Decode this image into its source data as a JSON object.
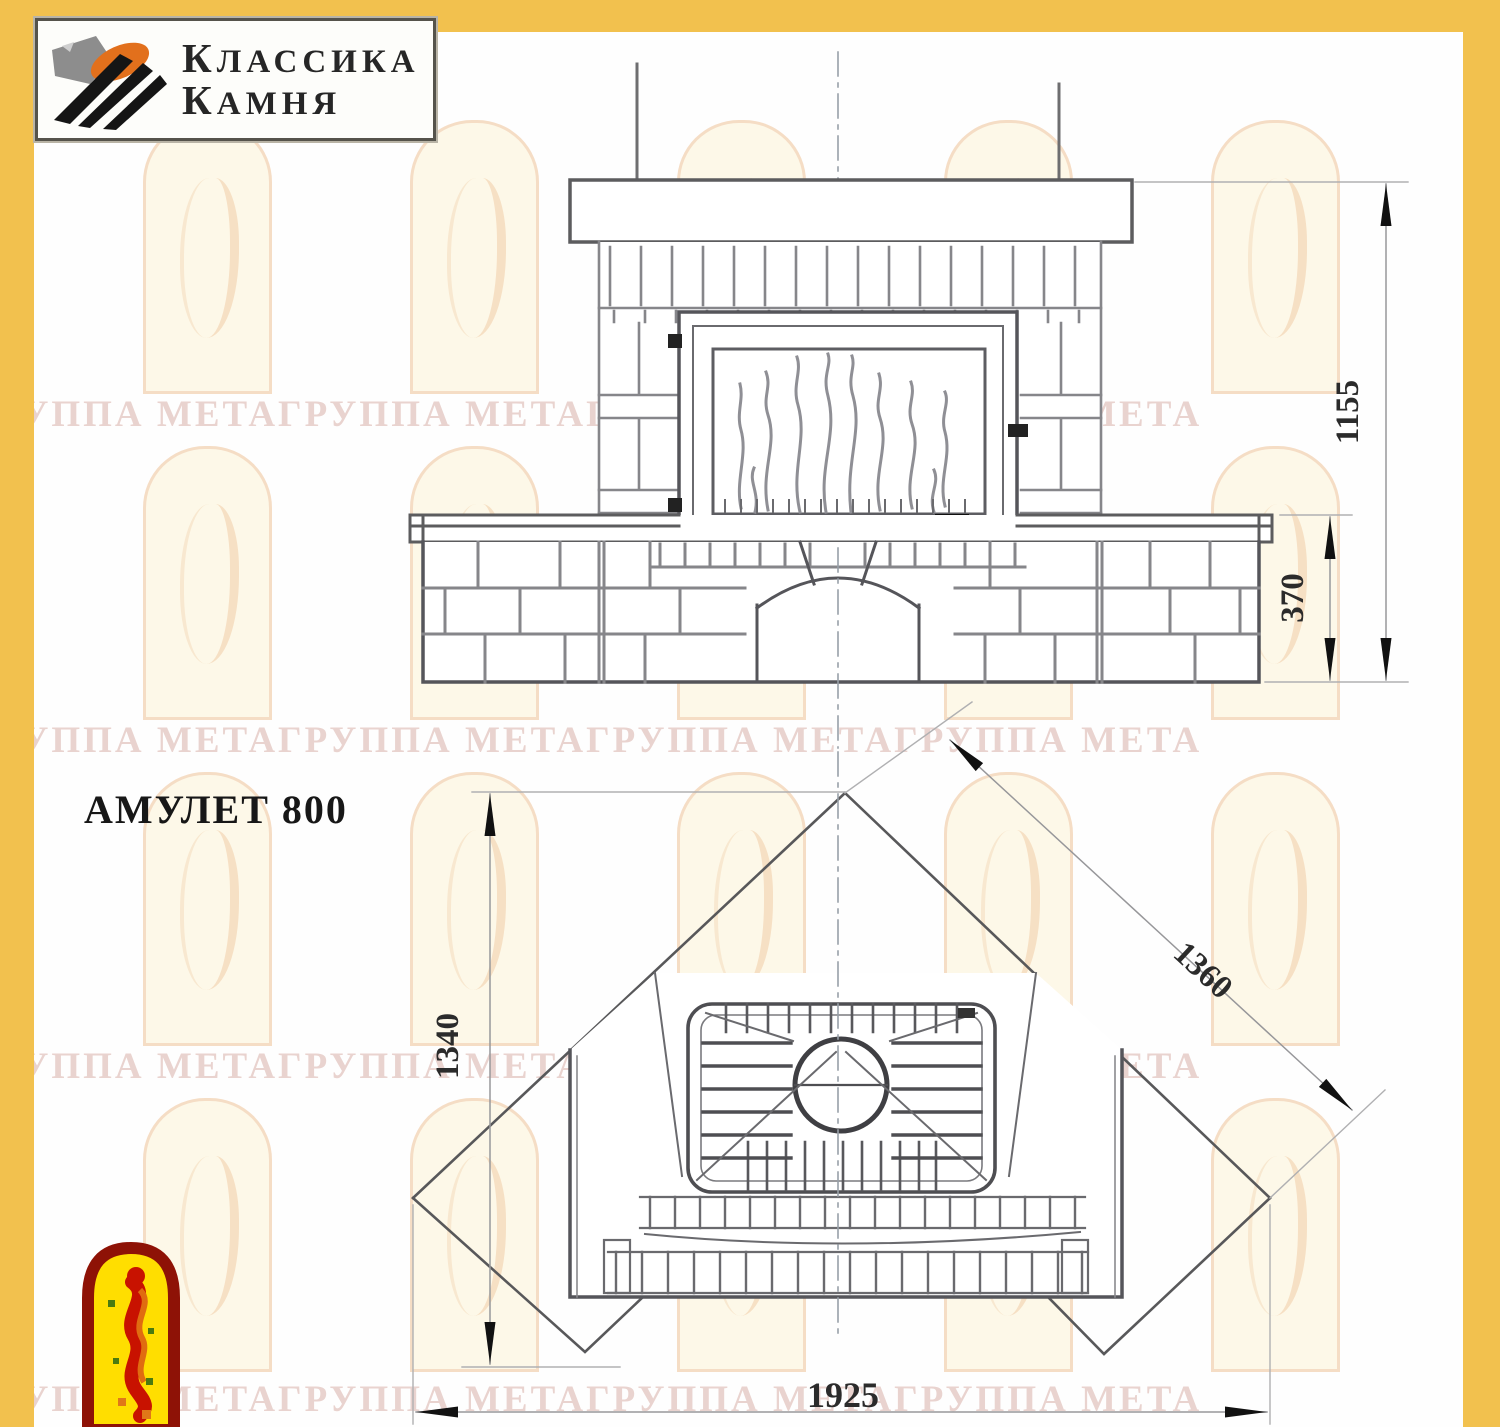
{
  "frame": {
    "color": "#F2C14E"
  },
  "brand_logo": {
    "line1": "КЛАССИКА",
    "line2": "КАМНЯ"
  },
  "title": "АМУЛЕТ 800",
  "watermark": {
    "text": "ГРУППА МЕТАГРУППА МЕТАГРУППА МЕТАГРУППА МЕТА"
  },
  "front_view": {
    "dim_total_height": "1155",
    "dim_bench_height": "370"
  },
  "plan_view": {
    "dim_depth": "1340",
    "dim_side": "1360",
    "dim_width": "1925"
  }
}
